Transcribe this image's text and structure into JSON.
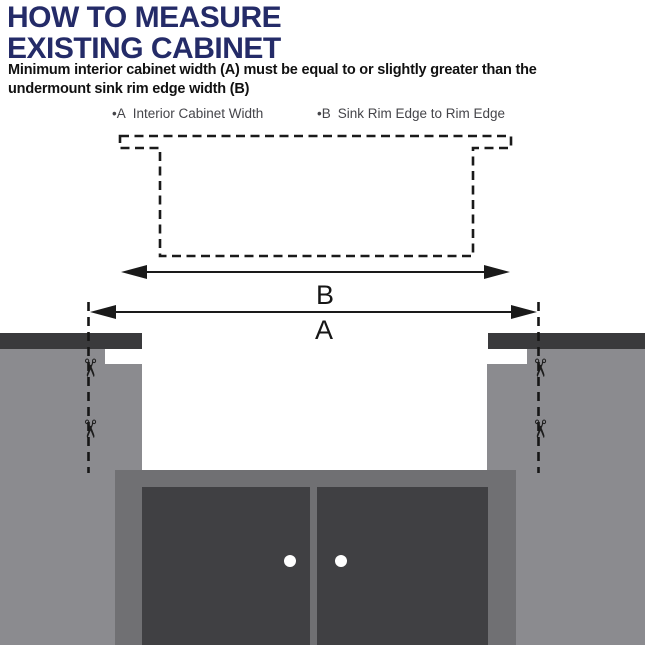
{
  "header": {
    "title_line1": "HOW TO MEASURE",
    "title_line2": "EXISTING CABINET",
    "subtitle_line1": "Minimum interior cabinet width (A) must be equal to or slightly greater than the",
    "subtitle_line2": "undermount sink rim edge width (B)"
  },
  "legend": {
    "items": [
      {
        "marker": "•A",
        "label": "Interior Cabinet Width"
      },
      {
        "marker": "•B",
        "label": "Sink Rim Edge to Rim Edge"
      }
    ]
  },
  "diagram": {
    "dimension_labels": {
      "b": "B",
      "a": "A"
    },
    "icons": {
      "scissors": "✂"
    },
    "colors": {
      "title": "#242b68",
      "text": "#111111",
      "legend_text": "#45454a",
      "line": "#1a1a1a",
      "countertop": "#3a3a3c",
      "cabinet_side": "#8b8b8f",
      "cabinet_face": "#707073",
      "cabinet_door": "#404043",
      "door_knob": "#ffffff",
      "background": "#ffffff"
    }
  }
}
